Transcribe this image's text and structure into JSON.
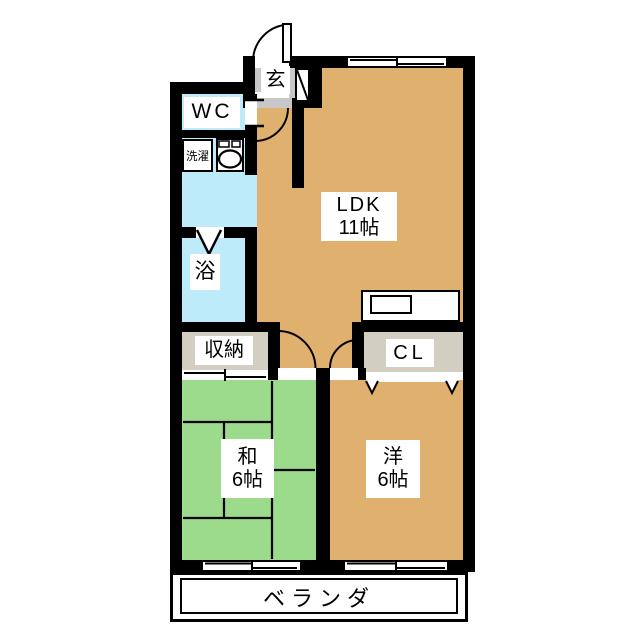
{
  "plan_title": "apartment-floor-plan",
  "colors": {
    "wall": "#000000",
    "ldk_orange": "#DFB06E",
    "tatami_green": "#9CDB8C",
    "water_blue": "#BEEBFA",
    "genkan_gray": "#C8C8C8",
    "closet_beige": "#D2CEC1",
    "bg": "#FFFFFF"
  },
  "rooms": {
    "entrance_label": "玄",
    "wc_label": "WC",
    "laundry_label": "洗濯",
    "bath_label": "浴",
    "storage_label": "収納",
    "ldk_label": "LDK",
    "ldk_size": "11帖",
    "closet_label": "CL",
    "japanese_room_label": "和",
    "japanese_room_size": "6帖",
    "western_room_label": "洋",
    "western_room_size": "6帖",
    "veranda_label": "ベランダ"
  }
}
